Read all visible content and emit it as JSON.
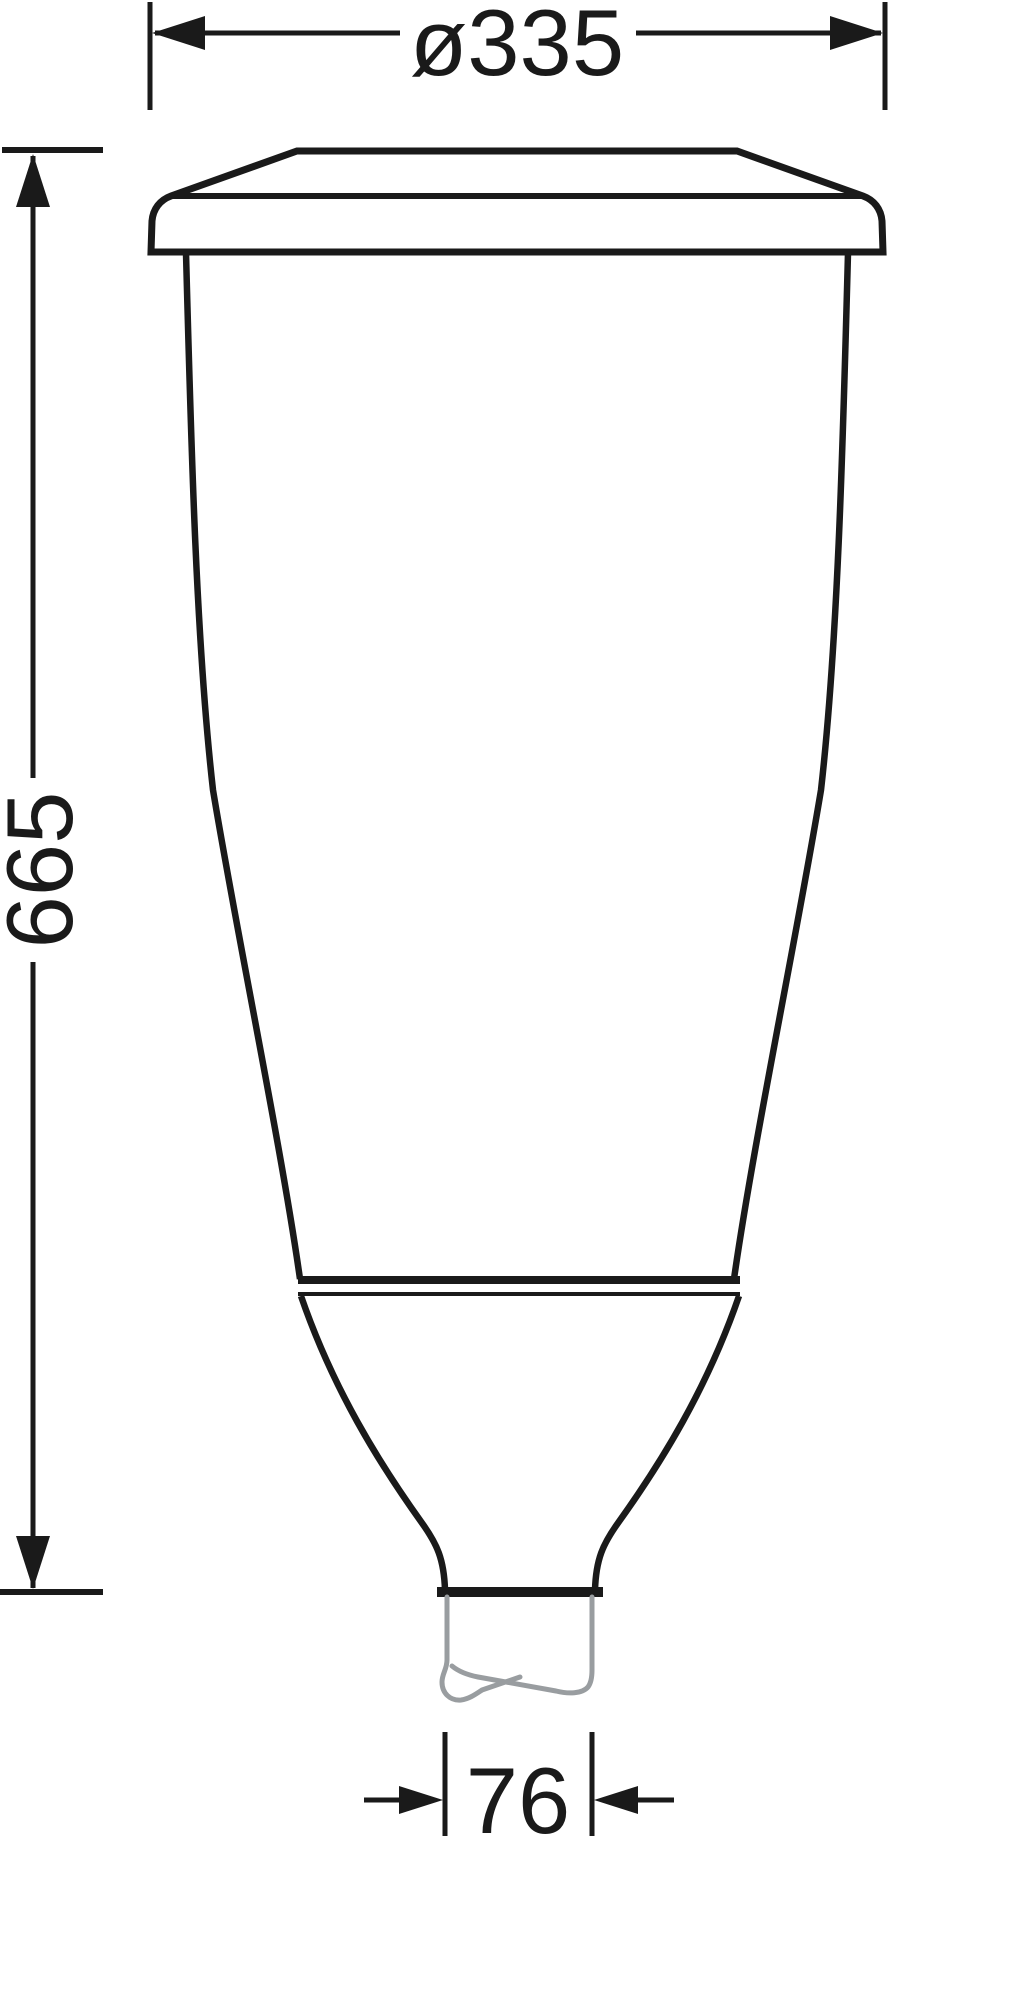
{
  "drawing": {
    "kind": "luminaire dimension drawing",
    "labels": {
      "diameter": "ø335",
      "height": "665",
      "spigot": "76"
    },
    "colors": {
      "line": "#1a1a1a",
      "pole_gray": "#999da0",
      "background": "#ffffff"
    }
  }
}
